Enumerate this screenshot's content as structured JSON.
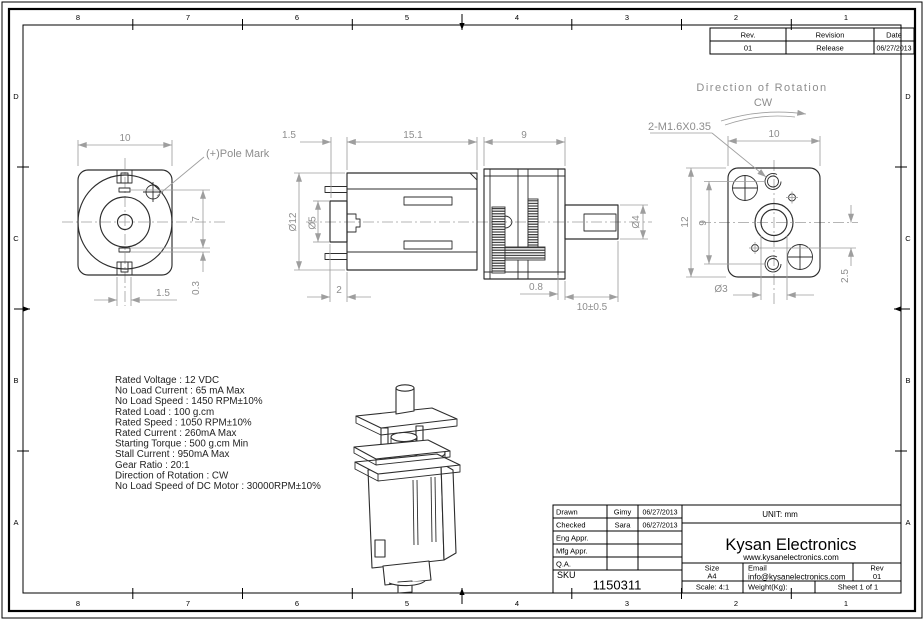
{
  "sheet": {
    "zones_top": [
      "8",
      "7",
      "6",
      "5",
      "4",
      "3",
      "2",
      "1"
    ],
    "zones_bottom": [
      "8",
      "7",
      "6",
      "5",
      "4",
      "3",
      "2",
      "1"
    ],
    "zones_left": [
      "D",
      "C",
      "B",
      "A"
    ],
    "zones_right": [
      "D",
      "C",
      "B",
      "A"
    ],
    "background": "#ffffff",
    "line_color": "#2d2d2d",
    "dim_color": "#9e9e9e"
  },
  "revision_table": {
    "col_rev": "Rev.",
    "col_revision": "Revision",
    "col_date": "Date",
    "row_rev": "01",
    "row_revision": "Release",
    "row_date": "06/27/2013"
  },
  "rotation": {
    "label": "Direction of Rotation",
    "value": "CW"
  },
  "rear_view": {
    "pole_mark": "(+)Pole Mark",
    "dim_width": "10",
    "dim_pin": "7",
    "dim_brush": "0.3",
    "dim_terminal": "1.5"
  },
  "side_view": {
    "dim_boss": "1.5",
    "dim_body": "15.1",
    "dim_gearbox": "9",
    "dim_dia_body": "Ø12",
    "dim_dia_boss": "Ø5",
    "dim_step": "2",
    "dim_plate": "0.8",
    "dim_shaft_dia": "Ø4",
    "dim_shaft_len": "10±0.5"
  },
  "face_view": {
    "thread_label": "2-M1.6X0.35",
    "dim_width": "10",
    "dim_height": "12",
    "dim_holes": "9",
    "dim_offset": "2.5",
    "dim_boss_dia": "Ø3"
  },
  "specs": {
    "lines": [
      "Rated Voltage : 12 VDC",
      "No Load Current : 65 mA Max",
      "No Load Speed : 1450 RPM±10%",
      "Rated Load : 100 g.cm",
      "Rated Speed : 1050 RPM±10%",
      "Rated Current : 260mA Max",
      "Starting Torque : 500 g.cm Min",
      "Stall Current : 950mA Max",
      "Gear Ratio : 20:1",
      "Direction of Rotation : CW",
      "No Load Speed of DC Motor : 30000RPM±10%"
    ]
  },
  "title_block": {
    "rows": [
      {
        "label": "Drawn",
        "name": "Gimy",
        "date": "06/27/2013"
      },
      {
        "label": "Checked",
        "name": "Sara",
        "date": "06/27/2013"
      },
      {
        "label": "Eng Appr.",
        "name": "",
        "date": ""
      },
      {
        "label": "Mfg Appr.",
        "name": "",
        "date": ""
      },
      {
        "label": "Q.A.",
        "name": "",
        "date": ""
      }
    ],
    "unit": "UNIT: mm",
    "company": "Kysan Electronics",
    "website": "www.kysanelectronics.com",
    "sku_label": "SKU",
    "sku": "1150311",
    "size_label": "Size",
    "size": "A4",
    "email_label": "Email",
    "email": "info@kysanelectronics.com",
    "rev_label": "Rev",
    "rev": "01",
    "scale": "Scale: 4:1",
    "weight": "Weight(Kg):",
    "sheet": "Sheet 1 of 1"
  }
}
